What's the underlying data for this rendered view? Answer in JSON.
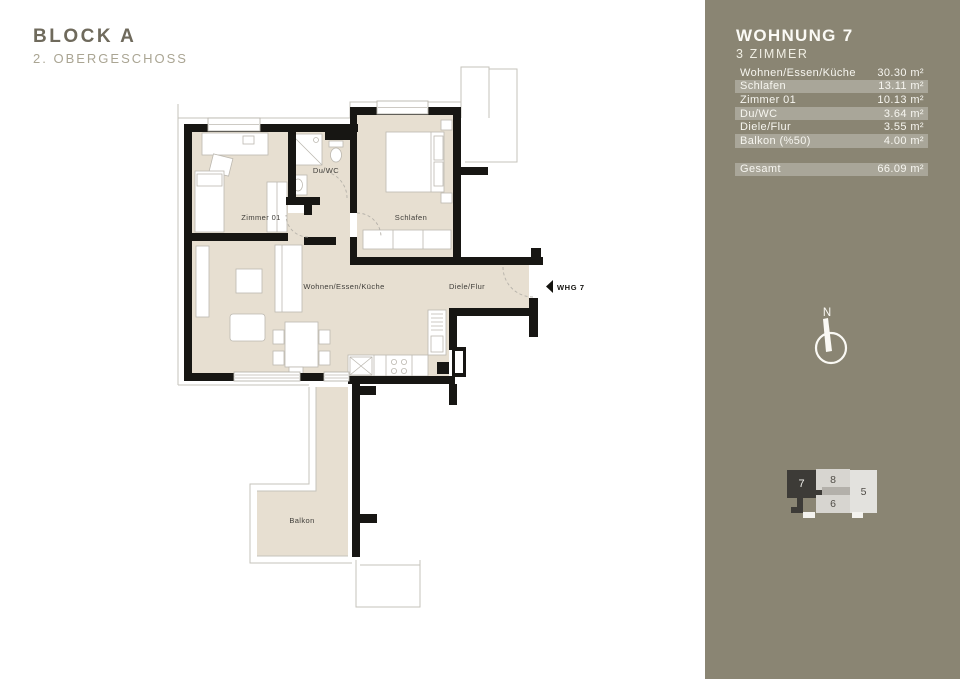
{
  "header": {
    "block": "BLOCK A",
    "floor": "2. OBERGESCHOSS"
  },
  "plan": {
    "rooms": {
      "zimmer01": "Zimmer 01",
      "duwc": "Du/WC",
      "schlafen": "Schlafen",
      "wohnen": "Wohnen/Essen/Küche",
      "diele": "Diele/Flur",
      "balkon": "Balkon"
    },
    "entry_label": "WHG 7",
    "compass_label": "N"
  },
  "sidebar": {
    "title": "WOHNUNG 7",
    "subtitle": "3 ZIMMER",
    "area_rows": [
      {
        "label": "Wohnen/Essen/Küche",
        "value": "30.30 m²"
      },
      {
        "label": "Schlafen",
        "value": "13.11 m²"
      },
      {
        "label": "Zimmer 01",
        "value": "10.13 m²"
      },
      {
        "label": "Du/WC",
        "value": "3.64 m²"
      },
      {
        "label": "Diele/Flur",
        "value": "3.55 m²"
      },
      {
        "label": "Balkon (%50)",
        "value": "4.00 m²"
      }
    ],
    "total_row": {
      "label": "Gesamt",
      "value": "66.09 m²"
    },
    "keyplan": {
      "highlighted_unit": "7",
      "units": [
        {
          "number": "7"
        },
        {
          "number": "8"
        },
        {
          "number": "5"
        },
        {
          "number": "6"
        }
      ]
    },
    "colors": {
      "sidebar_background": "#8a8573",
      "row_stripe": "rgba(255,255,255,0.27)",
      "room_fill": "#e7dfd1",
      "wall": "#171613",
      "keyplan_highlight": "#3d3b37"
    }
  }
}
